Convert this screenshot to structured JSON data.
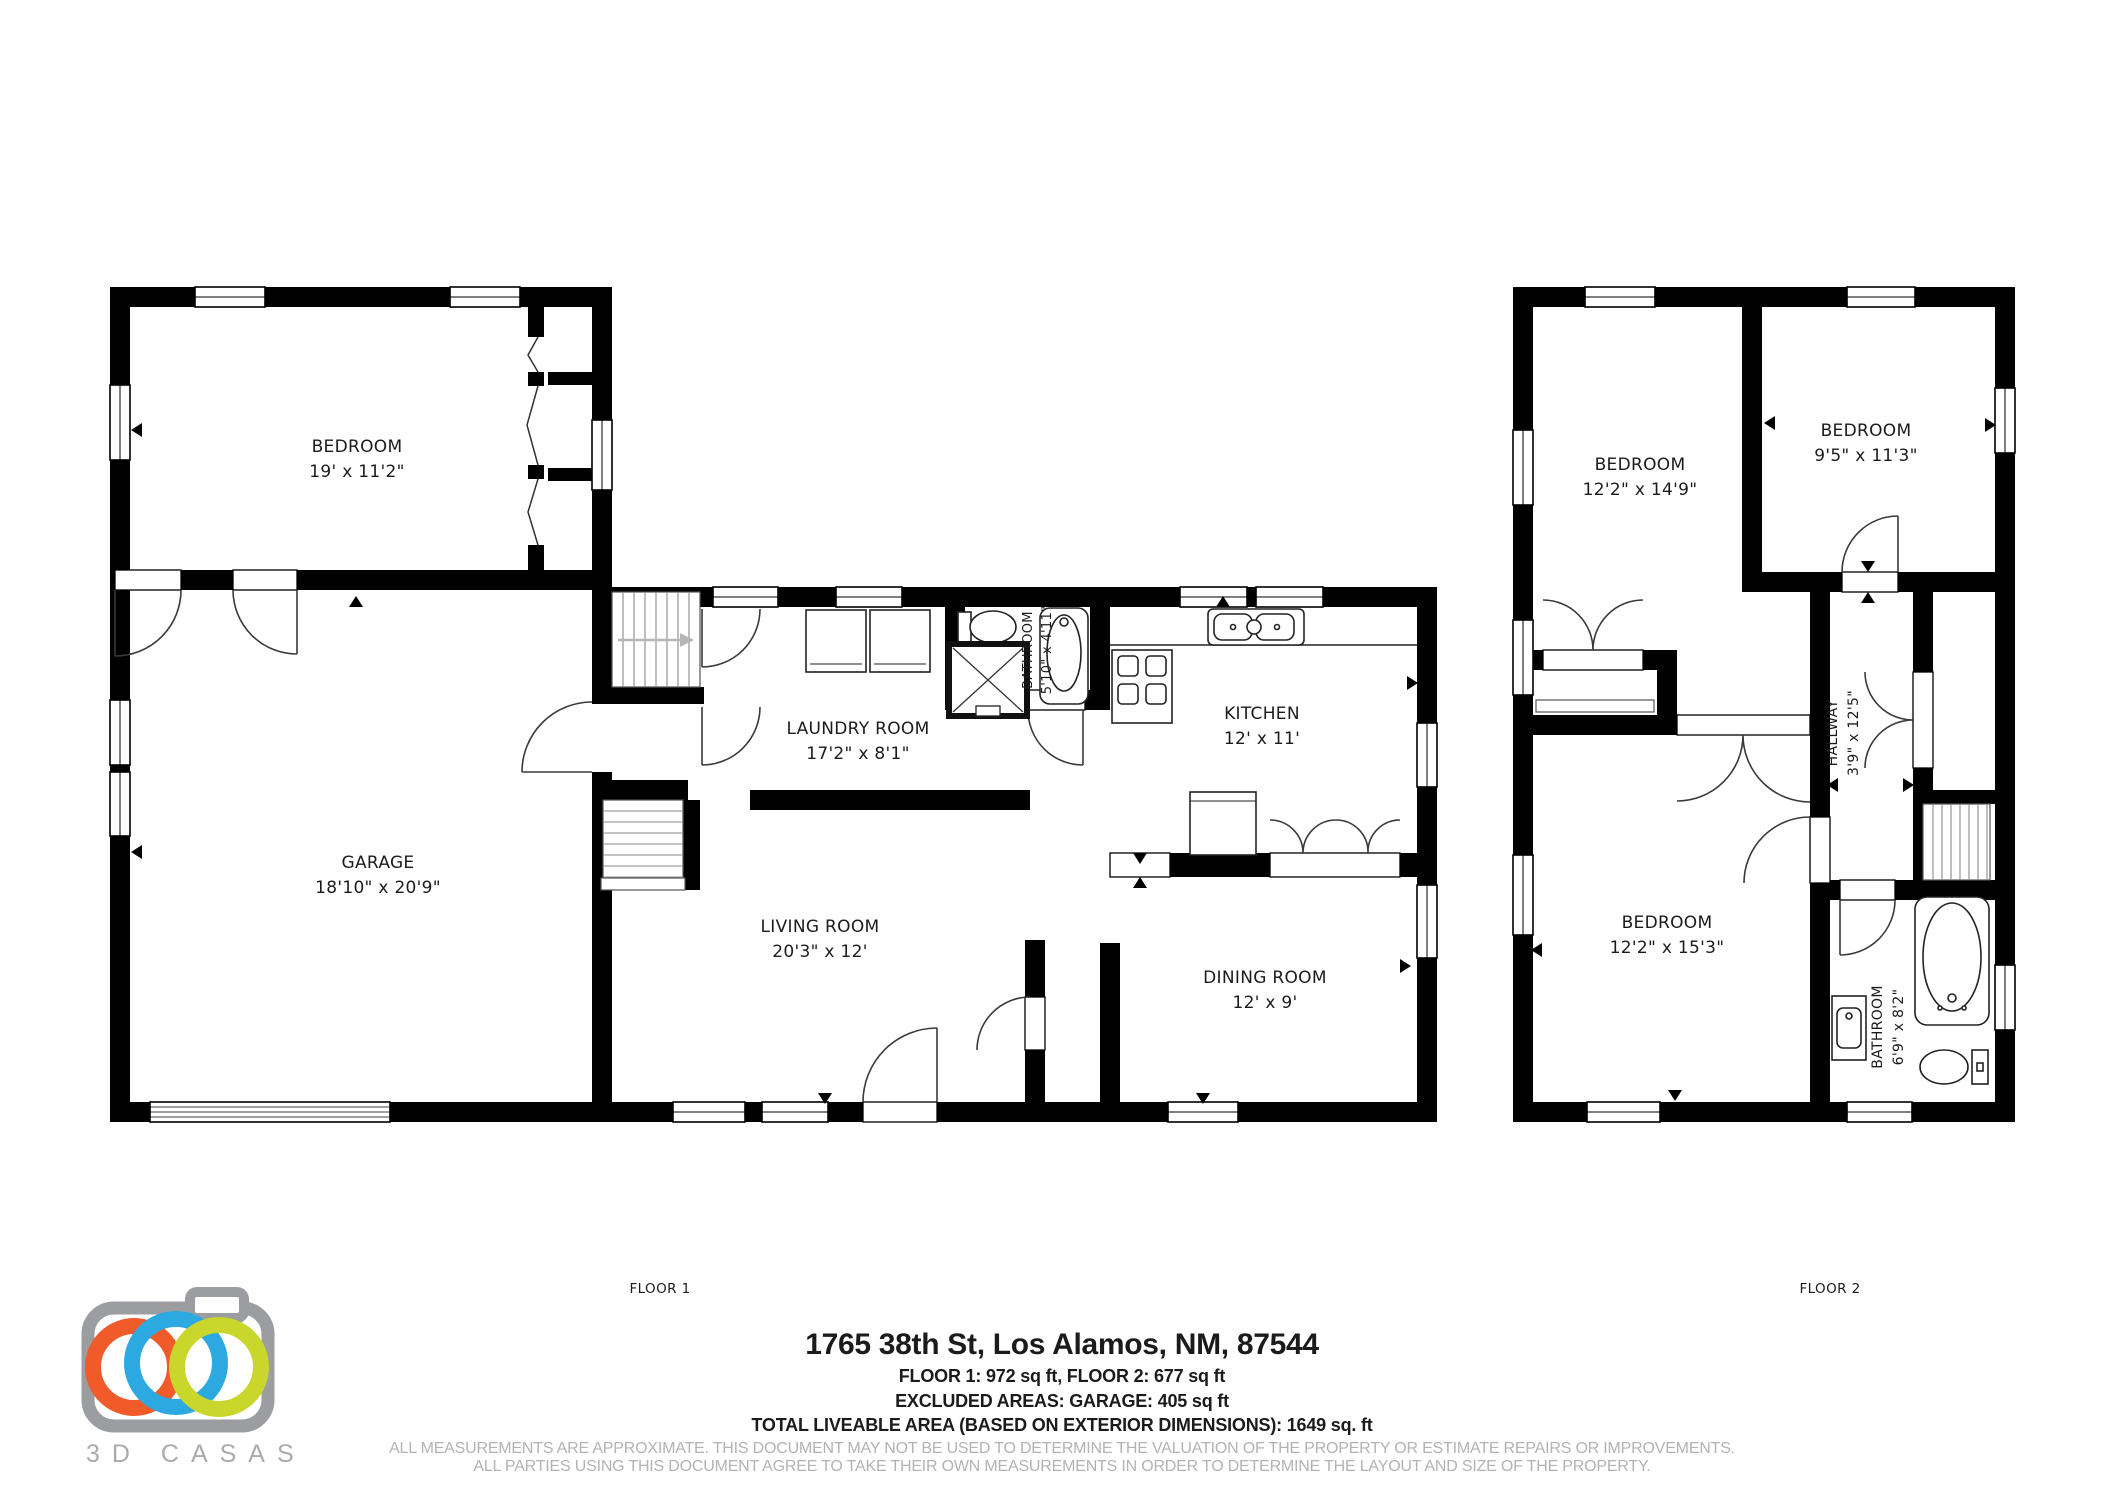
{
  "floor1": {
    "label": "FLOOR 1",
    "rooms": [
      {
        "name": "BEDROOM",
        "dims": "19' x 11'2\""
      },
      {
        "name": "GARAGE",
        "dims": "18'10\" x 20'9\""
      },
      {
        "name": "LAUNDRY ROOM",
        "dims": "17'2\" x 8'1\""
      },
      {
        "name": "BATHROOM",
        "dims": "5'10\" x 4'11\""
      },
      {
        "name": "KITCHEN",
        "dims": "12' x 11'"
      },
      {
        "name": "LIVING ROOM",
        "dims": "20'3\" x 12'"
      },
      {
        "name": "DINING ROOM",
        "dims": "12' x 9'"
      }
    ]
  },
  "floor2": {
    "label": "FLOOR 2",
    "rooms": [
      {
        "name": "BEDROOM",
        "dims": "12'2\" x 14'9\""
      },
      {
        "name": "BEDROOM",
        "dims": "9'5\" x 11'3\""
      },
      {
        "name": "HALLWAY",
        "dims": "3'9\" x 12'5\""
      },
      {
        "name": "BEDROOM",
        "dims": "12'2\" x 15'3\""
      },
      {
        "name": "BATHROOM",
        "dims": "6'9\" x 8'2\""
      }
    ]
  },
  "footer": {
    "address": "1765 38th St, Los Alamos, NM, 87544",
    "areas_line1": "FLOOR 1: 972 sq ft, FLOOR 2: 677 sq ft",
    "areas_line2": "EXCLUDED AREAS: GARAGE: 405 sq ft",
    "areas_line3": "TOTAL LIVEABLE AREA (BASED ON EXTERIOR DIMENSIONS): 1649 sq. ft",
    "disclaimer1": "ALL MEASUREMENTS ARE APPROXIMATE. THIS DOCUMENT MAY NOT BE USED TO DETERMINE THE VALUATION OF THE PROPERTY OR ESTIMATE REPAIRS OR IMPROVEMENTS.",
    "disclaimer2": "ALL PARTIES USING THIS DOCUMENT AGREE TO TAKE THEIR OWN MEASUREMENTS IN ORDER TO DETERMINE THE LAYOUT AND SIZE OF THE PROPERTY."
  },
  "logo": {
    "text": "3D CASAS",
    "camera_color": "#9b9da0",
    "ring_colors": {
      "orange": "#f15a29",
      "blue": "#2ba9e0",
      "green": "#c9d62c"
    }
  }
}
